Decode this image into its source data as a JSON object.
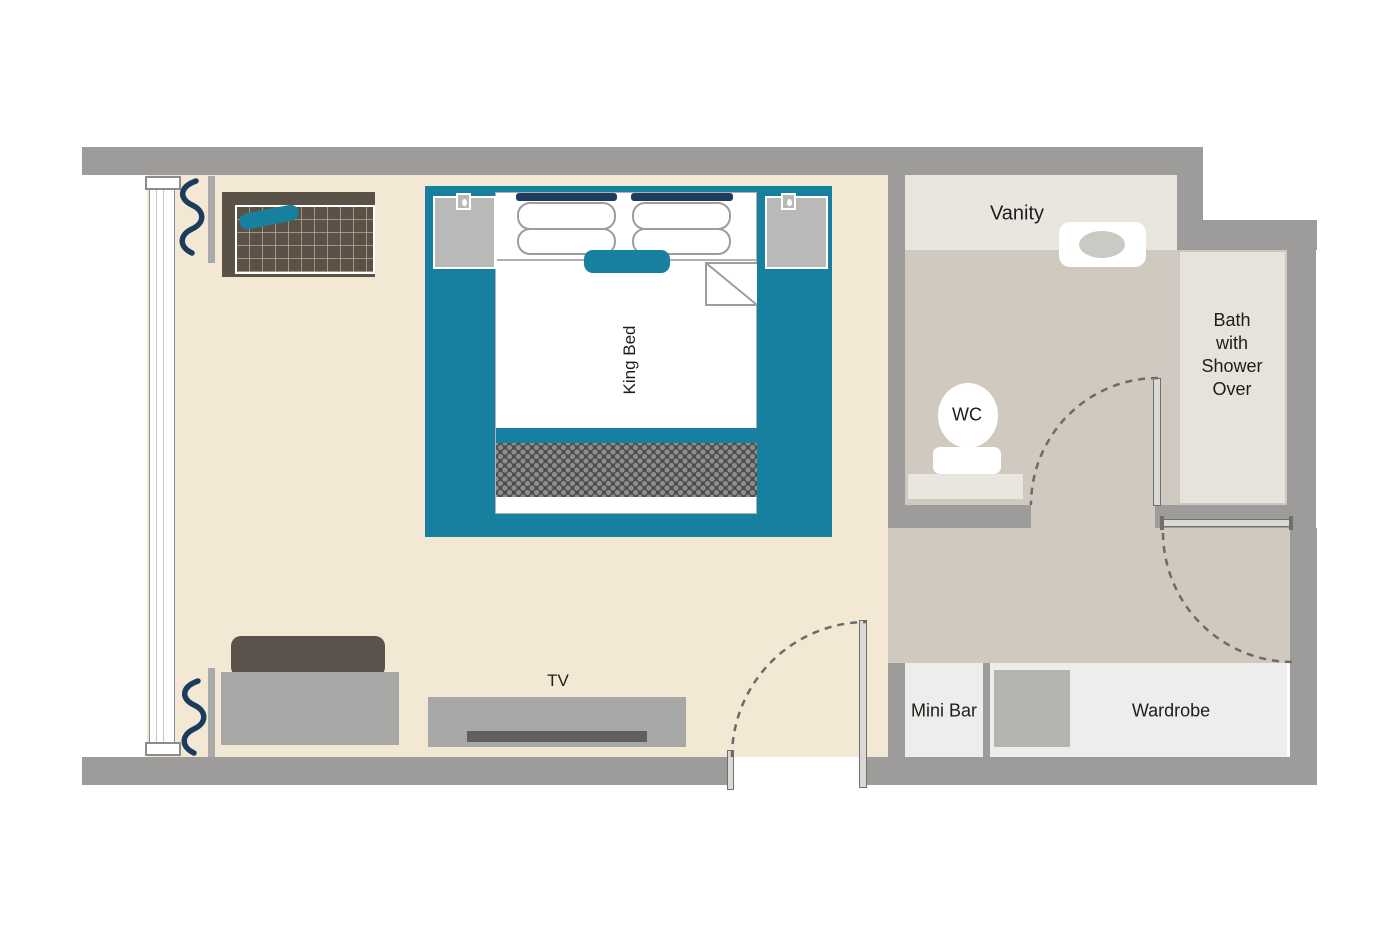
{
  "title": "King Room Floor Plan",
  "colors": {
    "teal": "#17809f",
    "navy": "#1c3c5e",
    "wall": "#9d9c9a",
    "bedroom_floor": "#f2e8d4",
    "bath_floor": "#cfc9c0",
    "counter": "#e9e6e0",
    "bath_fill": "#e6e3dc",
    "box_fill": "#ededeb",
    "furniture": "#a8a8a6",
    "dark_wood": "#5b5146",
    "sofa_back": "#5b534b",
    "nightstand": "#b9b9b7",
    "safe": "#b6b4b1",
    "outline": "#9d9d9b",
    "door_line": "#6f6f6d",
    "dot_bg": "#4e4d4b",
    "dot_fg": "#8f8e8c",
    "window_border": "#8c8c8a",
    "text": "#1d1d1b"
  },
  "labels": {
    "king_bed": "King Bed",
    "tv": "TV",
    "vanity": "Vanity",
    "wc": "WC",
    "bath": {
      "lines": [
        "Bath",
        "with",
        "Shower",
        "Over"
      ]
    },
    "mini_bar": "Mini Bar",
    "wardrobe": "Wardrobe"
  },
  "icons": {
    "nightstand_lamp": "small square with droplet bulb",
    "curtain": "navy wavy line",
    "door_swing": "dashed quarter-circle arc"
  }
}
